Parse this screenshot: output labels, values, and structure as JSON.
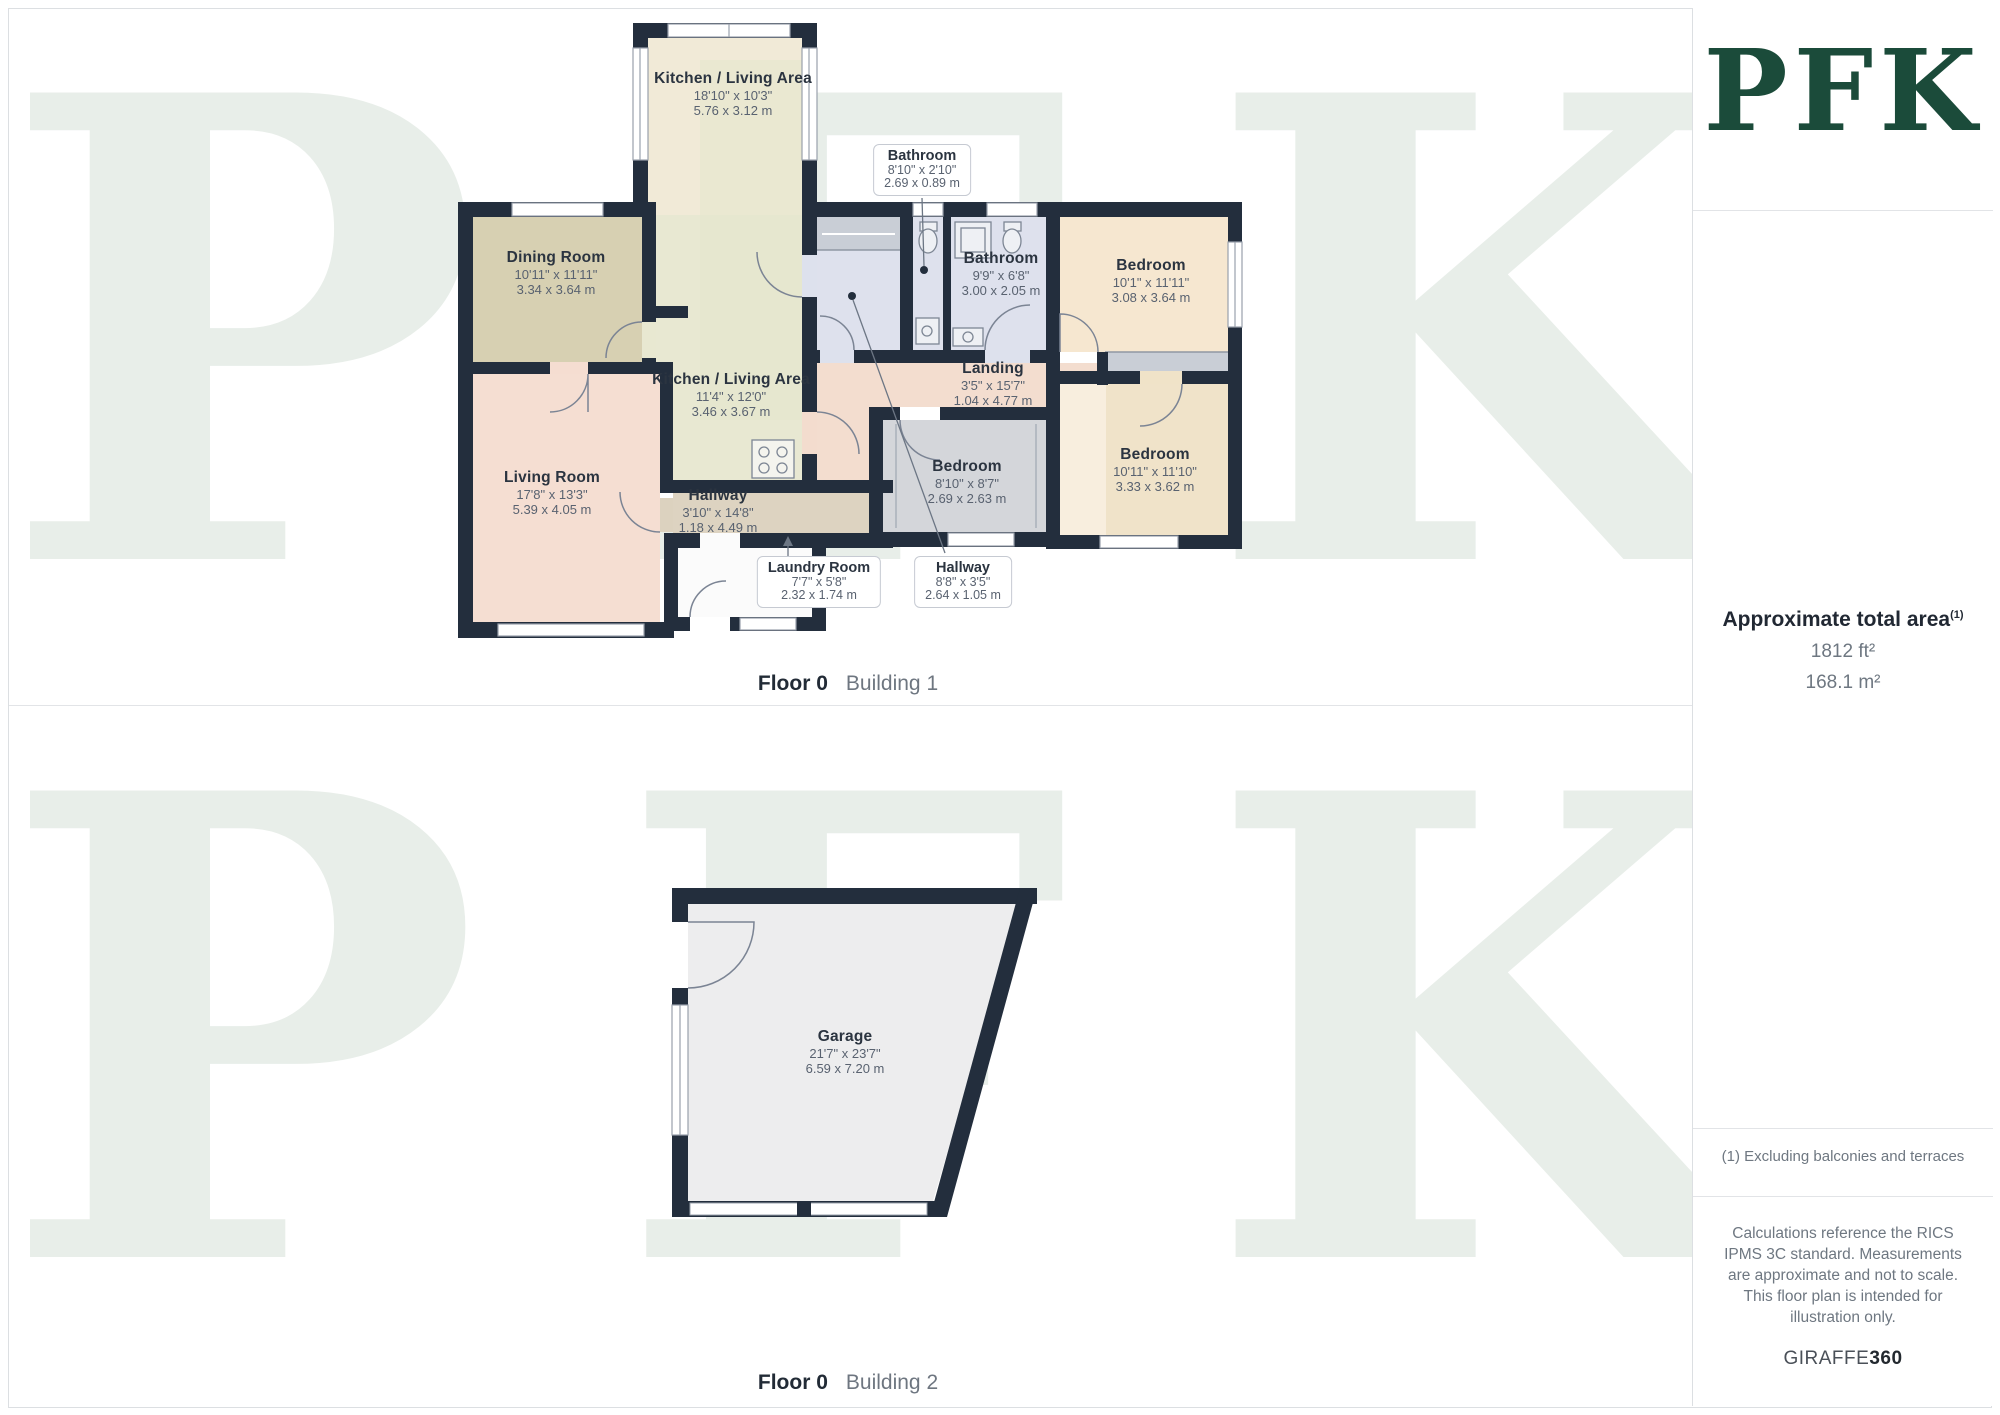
{
  "watermark": {
    "text": "PFK"
  },
  "captions": {
    "b1_floor": "Floor 0",
    "b1_name": "Building 1",
    "b2_floor": "Floor 0",
    "b2_name": "Building 2"
  },
  "plan1": {
    "kitchen_top": {
      "name": "Kitchen / Living Area",
      "imperial": "18'10\" x 10'3\"",
      "metric": "5.76 x 3.12 m"
    },
    "bathroom_callout": {
      "name": "Bathroom",
      "imperial": "8'10\" x 2'10\"",
      "metric": "2.69 x 0.89 m"
    },
    "bathroom": {
      "name": "Bathroom",
      "imperial": "9'9\" x 6'8\"",
      "metric": "3.00 x 2.05 m"
    },
    "bedroom_tr": {
      "name": "Bedroom",
      "imperial": "10'1\" x 11'11\"",
      "metric": "3.08 x 3.64 m"
    },
    "dining": {
      "name": "Dining Room",
      "imperial": "10'11\" x 11'11\"",
      "metric": "3.34 x 3.64 m"
    },
    "kitchen_mid": {
      "name": "Kitchen / Living Area",
      "imperial": "11'4\" x 12'0\"",
      "metric": "3.46 x 3.67 m"
    },
    "landing": {
      "name": "Landing",
      "imperial": "3'5\" x 15'7\"",
      "metric": "1.04 x 4.77 m"
    },
    "living": {
      "name": "Living Room",
      "imperial": "17'8\" x 13'3\"",
      "metric": "5.39 x 4.05 m"
    },
    "hallway": {
      "name": "Hallway",
      "imperial": "3'10\" x 14'8\"",
      "metric": "1.18 x 4.49 m"
    },
    "bedroom_mid": {
      "name": "Bedroom",
      "imperial": "8'10\" x 8'7\"",
      "metric": "2.69 x 2.63 m"
    },
    "bedroom_br": {
      "name": "Bedroom",
      "imperial": "10'11\" x 11'10\"",
      "metric": "3.33 x 3.62 m"
    },
    "laundry_callout": {
      "name": "Laundry Room",
      "imperial": "7'7\" x 5'8\"",
      "metric": "2.32 x 1.74 m"
    },
    "hallway_callout": {
      "name": "Hallway",
      "imperial": "8'8\" x 3'5\"",
      "metric": "2.64 x 1.05 m"
    }
  },
  "plan2": {
    "garage": {
      "name": "Garage",
      "imperial": "21'7\" x 23'7\"",
      "metric": "6.59 x 7.20 m"
    }
  },
  "sidebar": {
    "logo": "PFK",
    "area_title": "Approximate total area",
    "area_sup": "(1)",
    "area_ft": "1812 ft²",
    "area_m": "168.1 m²",
    "footnote": "(1) Excluding balconies and terraces",
    "disclaimer": "Calculations reference the RICS IPMS 3C standard. Measurements are approximate and not to scale. This floor plan is intended for illustration only.",
    "brand_giraffe": "GIRAFFE",
    "brand_360": "360"
  },
  "colors": {
    "wall": "#232e3d",
    "brand_green": "#1b4b3a",
    "watermark": "#e8eee9"
  }
}
